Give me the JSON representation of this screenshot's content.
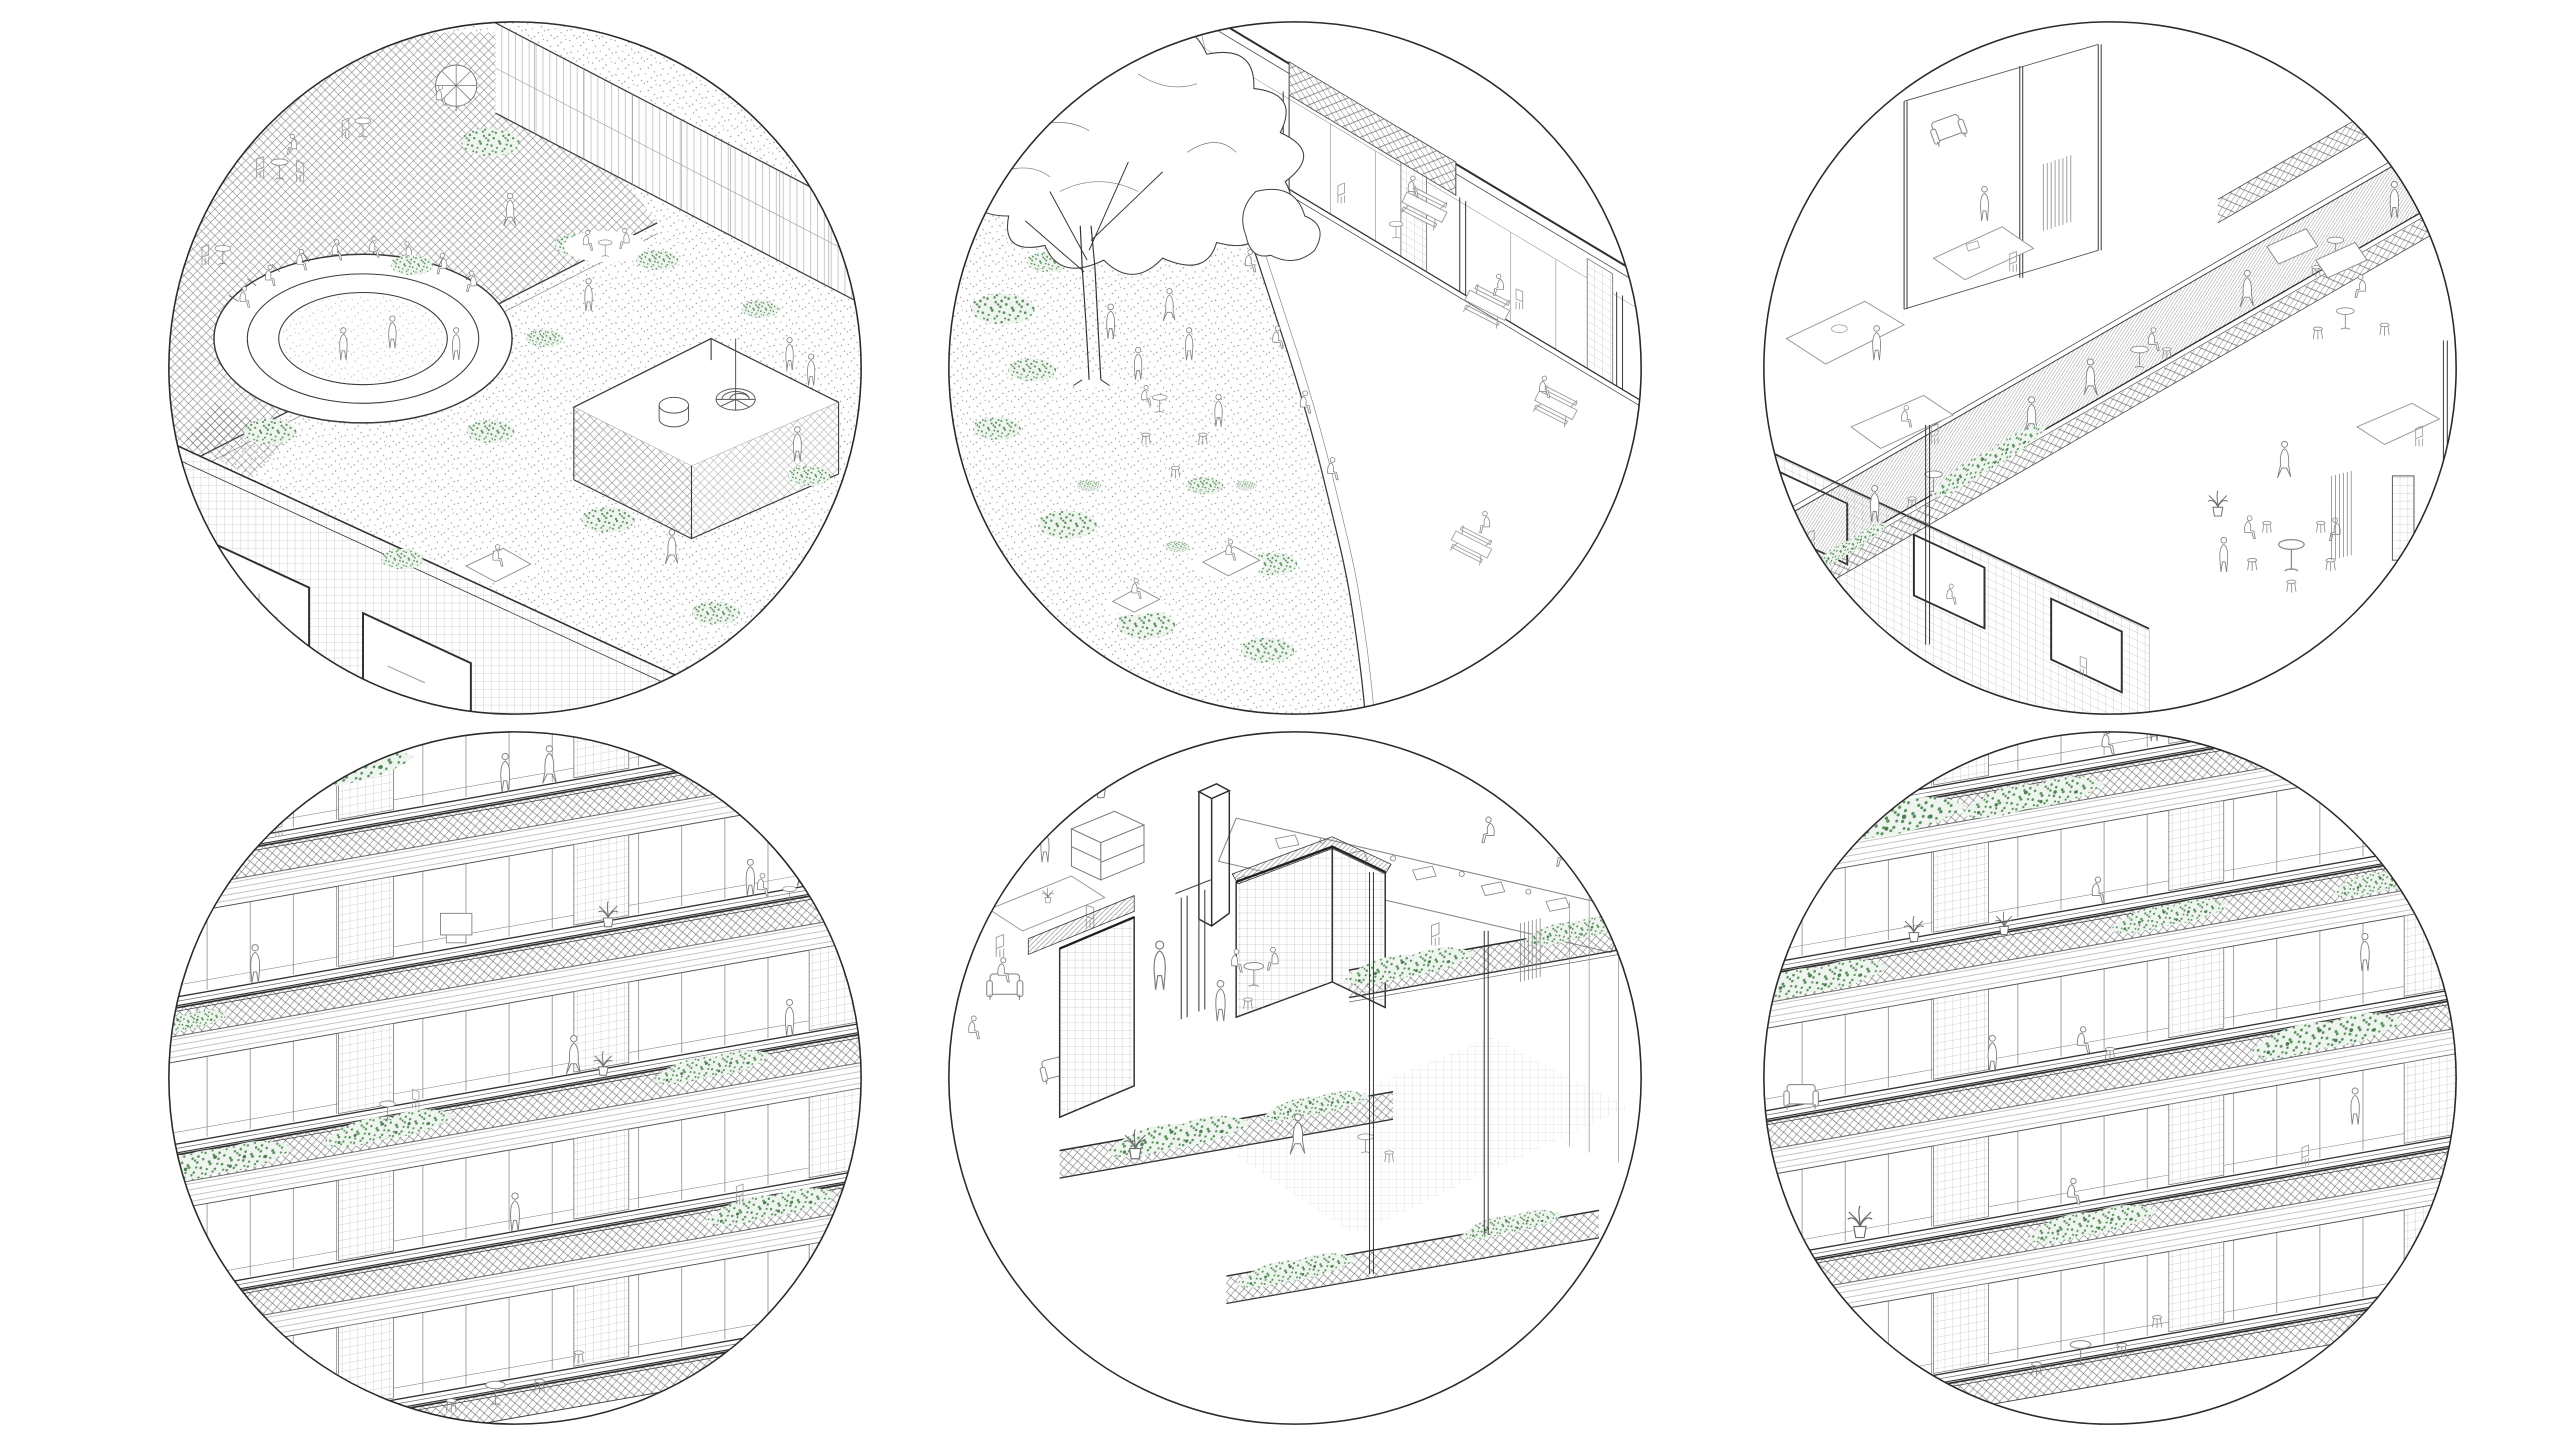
{
  "canvas": {
    "width": 2550,
    "height": 1440,
    "background": "#ffffff"
  },
  "palette": {
    "canvas_bg": "#ffffff",
    "ink": "#2f2f2f",
    "line_mid": "#6f6f6f",
    "line_light": "#9a9a9a",
    "vegetation": "#5c8f5e",
    "vegetation_dark": "#4e7f52",
    "vegetation_tint": "#eef4ee",
    "circle_outline": "#2a2a2a"
  },
  "figure": {
    "type": "architectural-vignette-grid",
    "rows": 2,
    "columns": 3,
    "style": "black-and-white axonometric architectural line drawings in circular crops, green stipple vegetation accents, white background, no text"
  },
  "vignettes": [
    {
      "id": "roof-garden",
      "row": 1,
      "col": 1,
      "title": "Roof garden axonometric",
      "description": "Green roof with stippled planting, circular sunken amphitheatre seating with people, cross-hatched cafe terrace with round tables, glass pavilion with spiral stair, building facade with gridded tiles and windows below",
      "elements": [
        "stippled green roof",
        "amphitheatre",
        "cafe terrace",
        "mesh pavilion",
        "spiral stair",
        "shrubs",
        "people"
      ]
    },
    {
      "id": "courtyard-lawn",
      "row": 1,
      "col": 2,
      "title": "Courtyard with large tree",
      "description": "Stippled lawn with a large line-drawn tree, scattered green shrubs, people on stools and picnic blankets, curved edge to a paved terrace with picnic tables along a glazed facade with tiled piers and cross-hatched clerestory",
      "elements": [
        "tree",
        "lawn stipple",
        "picnic tables",
        "glazed facade",
        "shrubs",
        "people"
      ]
    },
    {
      "id": "interior-gallery",
      "row": 1,
      "col": 3,
      "title": "Interior gallery walkway",
      "description": "Cutaway axonometric of an elevated hatched walkway with cafe tables and mesh balustrade, flanking rooms with desks, curtains, sofas and round tables, tiled piers, green planting spilling from the gallery edge",
      "elements": [
        "hatched walkway",
        "mesh balustrade",
        "rooms",
        "curtains",
        "round tables",
        "vine planting",
        "people"
      ]
    },
    {
      "id": "facade-balconies-west",
      "row": 2,
      "col": 1,
      "title": "Facade with planted walkway balconies",
      "description": "Diagonal facade bands: tiled piers and glazing, slab edges, cross-hatched mesh balustrades with trailing green planting, people walking on the walkways, stools and tables behind glass at ground level",
      "elements": [
        "mesh balustrades",
        "trailing vines",
        "tiled piers",
        "glazing",
        "people",
        "bar stools"
      ]
    },
    {
      "id": "interior-workspace",
      "row": 2,
      "col": 2,
      "title": "Interior workspace cutaway",
      "description": "Open-plan interior with long worktable, laptops and seated people, freestanding column, tiled wall volumes with hatched parapet beams, sliding glass doors, armchairs, potted plants and planted balcony edges with mesh railings",
      "elements": [
        "long worktable",
        "laptops",
        "column",
        "tiled volumes",
        "sliding doors",
        "armchairs",
        "potted plants",
        "planted balcony"
      ]
    },
    {
      "id": "facade-balconies-east",
      "row": 2,
      "col": 3,
      "title": "Facade with window seats and planters",
      "description": "Diagonal facade bands with cross-hatched planter balustrades full of green vines, people seated at window sills and walking the decks, potted plants, cafe table with stools at the lower level",
      "elements": [
        "planter balustrades",
        "vines",
        "window seats",
        "tiled piers",
        "cafe table",
        "stools",
        "people"
      ]
    }
  ]
}
